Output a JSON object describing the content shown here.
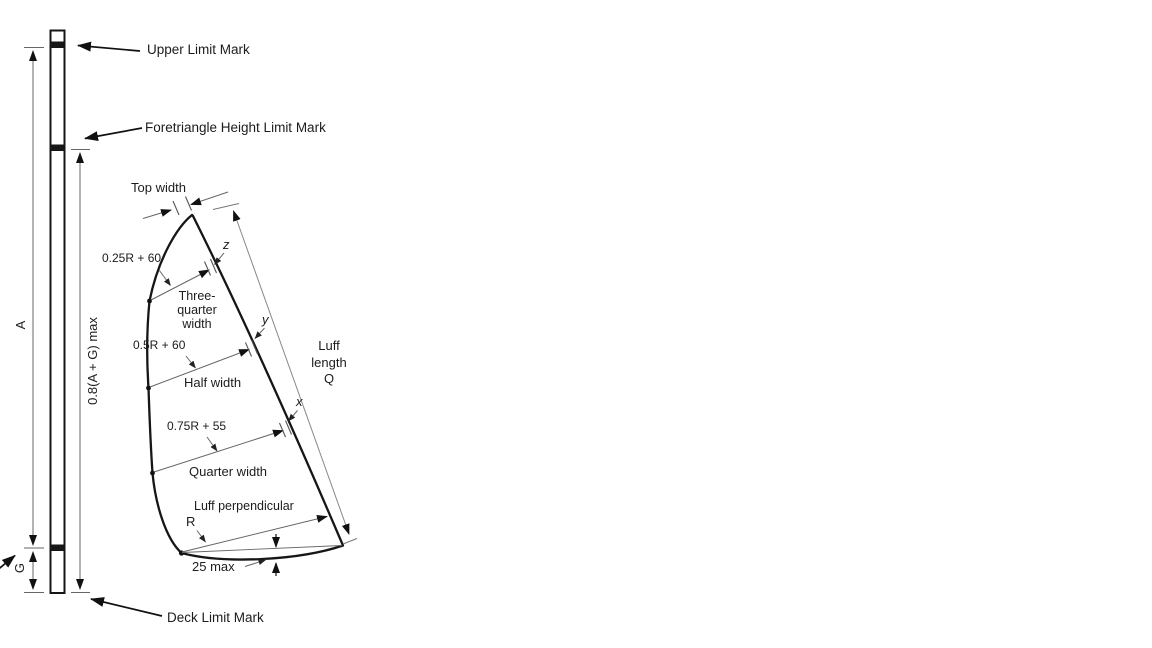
{
  "labels": {
    "upper_limit": "Upper Limit Mark",
    "foretriangle": "Foretriangle Height Limit Mark",
    "deck": "Deck Limit Mark",
    "dim_a": "A",
    "dim_g": "G",
    "dim_amax": "0.8(A + G) max",
    "top_width": "Top width",
    "point_z": "z",
    "point_y": "y",
    "point_x": "x",
    "formula_three_quarter": "0.25R + 60",
    "three_quarter_line1": "Three-",
    "three_quarter_line2": "quarter",
    "three_quarter_line3": "width",
    "formula_half": "0.5R + 60",
    "half_width": "Half width",
    "luff_line1": "Luff",
    "luff_line2": "length",
    "luff_line3": "Q",
    "formula_quarter": "0.75R + 55",
    "quarter_width": "Quarter width",
    "luff_perpendicular": "Luff perpendicular",
    "dim_r": "R",
    "foot_round": "25 max"
  },
  "colors": {
    "line": "#1a1a1a",
    "dim": "#606060",
    "text": "#1c1c1c",
    "background": "#ffffff"
  }
}
